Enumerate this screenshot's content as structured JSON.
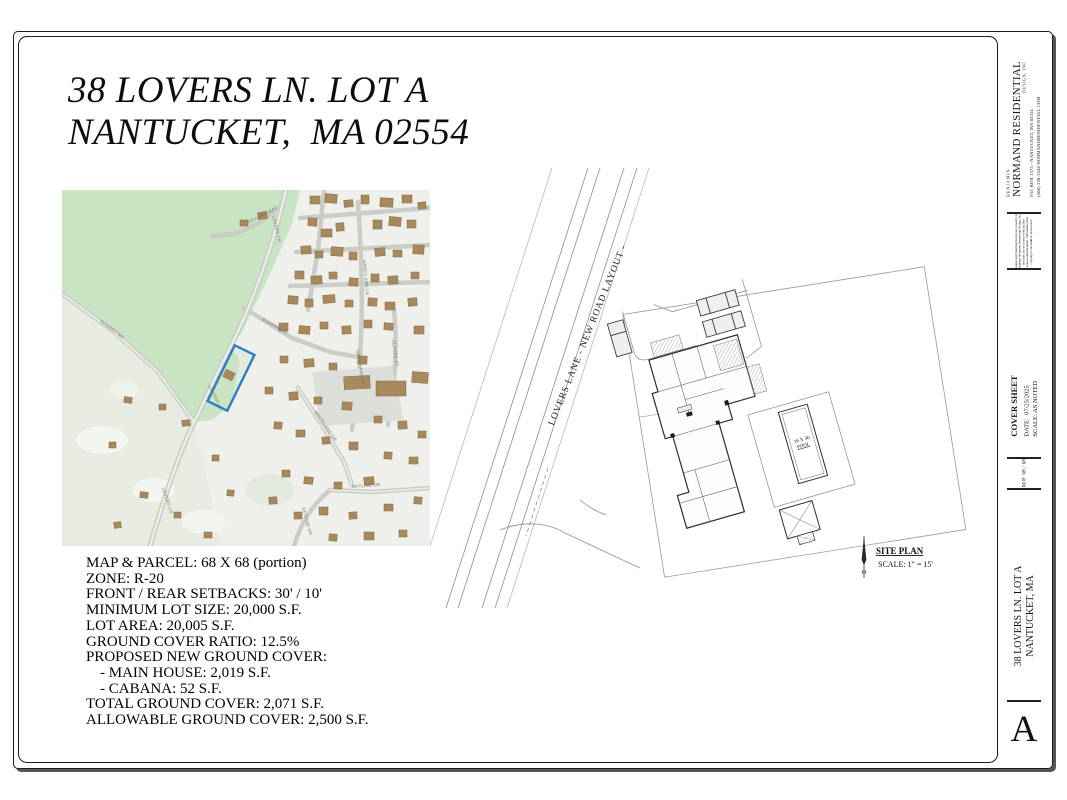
{
  "heading": {
    "line1": "38 LOVERS LN. LOT A",
    "line2": "NANTUCKET,  MA 02554"
  },
  "zoning": {
    "lines": [
      "MAP & PARCEL: 68 X 68 (portion)",
      "ZONE: R-20",
      "FRONT / REAR SETBACKS: 30' / 10'",
      "MINIMUM LOT SIZE: 20,000 S.F.",
      "LOT AREA: 20,005 S.F.",
      "GROUND COVER RATIO: 12.5%",
      "PROPOSED NEW GROUND COVER:",
      "- MAIN HOUSE: 2,019 S.F.",
      "- CABANA: 52 S.F.",
      "TOTAL GROUND COVER: 2,071 S.F.",
      "ALLOWABLE GROUND COVER: 2,500 S.F."
    ]
  },
  "map": {
    "labels": [
      "TICCOMA WAY",
      "LOVERS LN",
      "LOVERS LN",
      "LOVERS LN",
      "NANCY ANN LN",
      "NANCY ANN LN",
      "DUNHAM LN",
      "NUGGET RD",
      "WOODLAND DR",
      "SKYLINE DR",
      "SKYLINE DR",
      "CLOVER ST"
    ],
    "parcel_outline_color": "#2b7ec6"
  },
  "site_plan": {
    "road_label": "LOVERS LANE - NEW ROAD LAYOUT -",
    "pool_line1": "16 X 36",
    "pool_line2": "POOL",
    "caption_title": "SITE PLAN",
    "caption_scale": "SCALE: 1\" = 15'"
  },
  "titleblock": {
    "firm_small_top": "BENJAMIN",
    "firm_name": "NORMAND RESIDENTIAL",
    "firm_small_bottom": "DESIGN, INC",
    "address": "P.O. BOX 1375 - NANTUCKET, MA 02554",
    "phone_web": "(508) 228-3344    NORMANDRESIDENTIAL.COM",
    "disclaimer": "Designs and drawings herein are property of\nBenjamin Normand Residential Design, Inc.\nand may not be reused without their\nexpress authorization. All unauthorized\ncopying or use shall be prosecuted.",
    "sheet_title": "COVER SHEET",
    "date_line": "DATE:  07/25/2025",
    "scale_line": "SCALE: AS NOTED",
    "map_parcel": "M/P: 68 / 68",
    "project_line1": "38 LOVERS LN. LOT A",
    "project_line2": "NANTUCKET, MA",
    "sheet_letter": "A"
  }
}
